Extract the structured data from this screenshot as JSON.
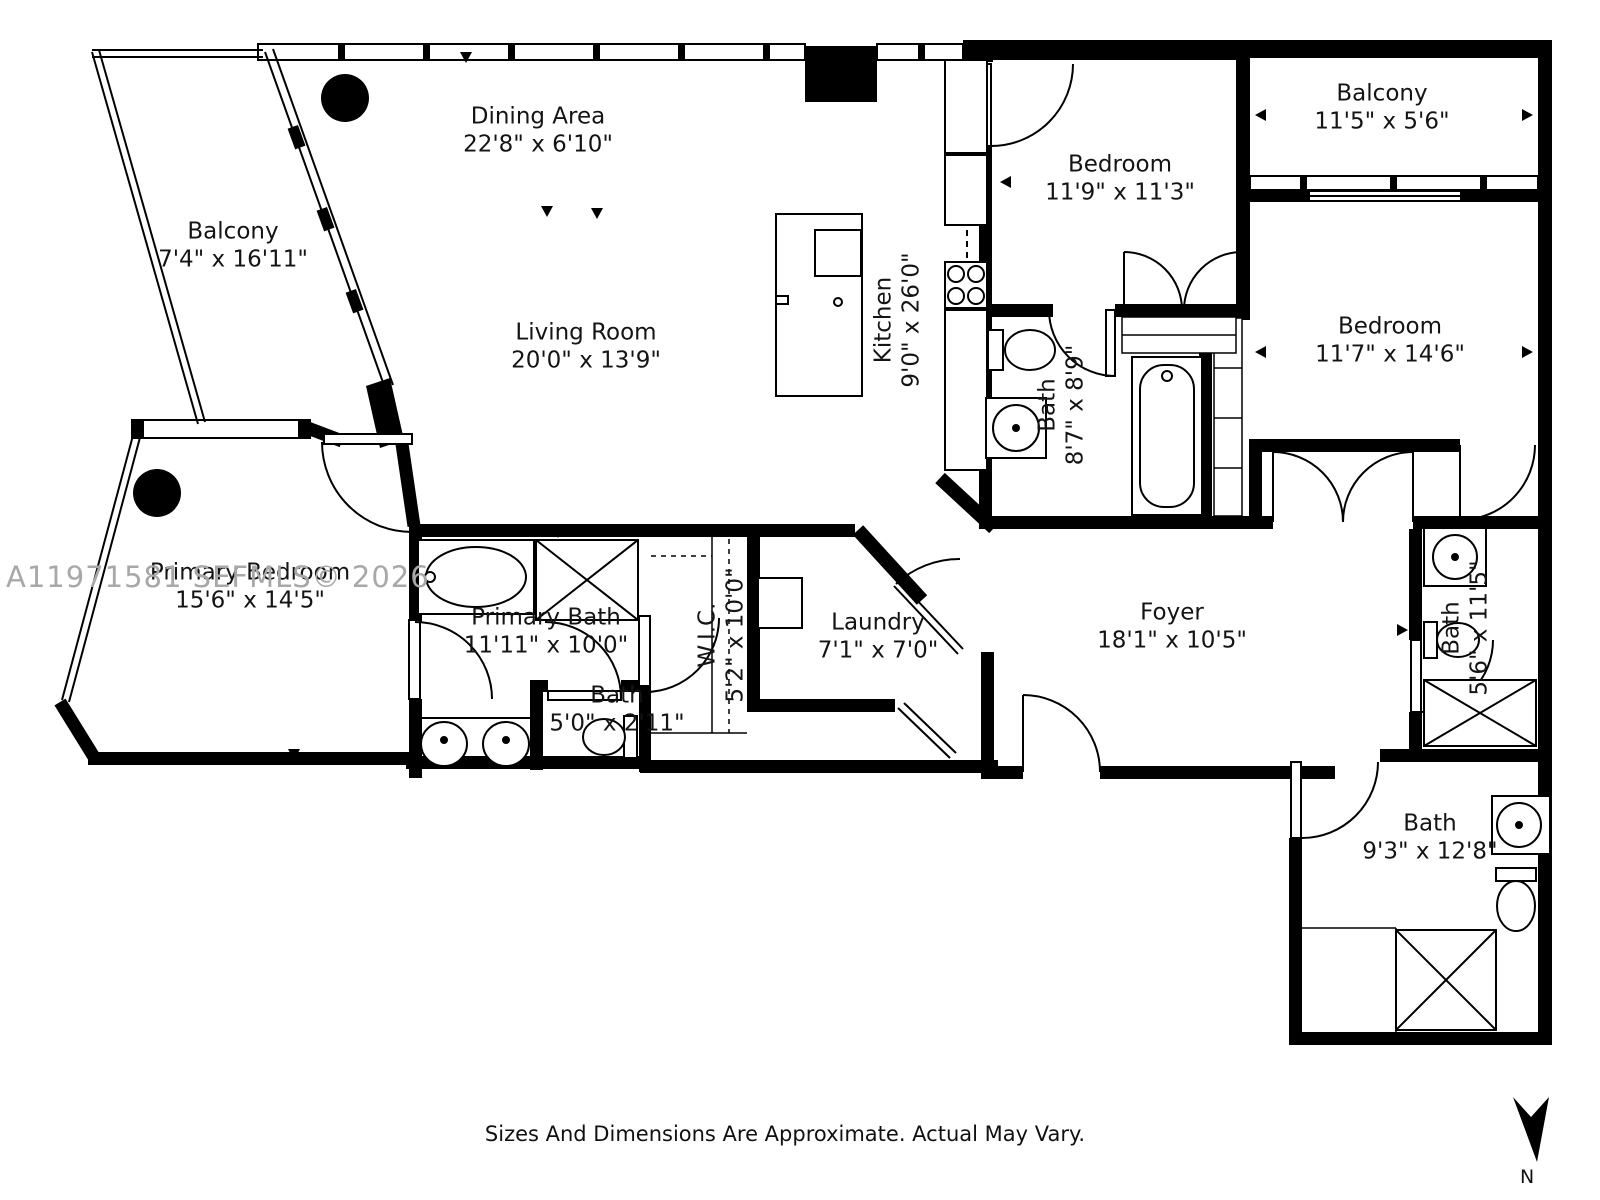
{
  "watermark": "A11971581 SEFMLS© 2026",
  "footer": {
    "disclaimer": "Sizes And Dimensions Are Approximate. Actual May Vary.",
    "north_label": "N"
  },
  "rooms": {
    "dining": {
      "name": "Dining Area",
      "dims": "22'8\" x 6'10\""
    },
    "balcony_top": {
      "name": "Balcony",
      "dims": "11'5\" x 5'6\""
    },
    "bedroom_top": {
      "name": "Bedroom",
      "dims": "11'9\" x 11'3\""
    },
    "balcony_left": {
      "name": "Balcony",
      "dims": "7'4\" x 16'11\""
    },
    "living": {
      "name": "Living Room",
      "dims": "20'0\" x 13'9\""
    },
    "kitchen": {
      "name": "Kitchen",
      "dims": "9'0\" x 26'0\""
    },
    "bath_ensuite": {
      "name": "Bath",
      "dims": "8'7\" x 8'9\""
    },
    "bedroom_right": {
      "name": "Bedroom",
      "dims": "11'7\" x 14'6\""
    },
    "primary_bedroom": {
      "name": "Primary Bedroom",
      "dims": "15'6\" x 14'5\""
    },
    "primary_bath": {
      "name": "Primary Bath",
      "dims": "11'11\" x 10'0\""
    },
    "bath_small": {
      "name": "Bath",
      "dims": "5'0\" x 2'11\""
    },
    "wic": {
      "name": "W.I.C.",
      "dims": "5'2\" x 10'0\""
    },
    "laundry": {
      "name": "Laundry",
      "dims": "7'1\" x 7'0\""
    },
    "foyer": {
      "name": "Foyer",
      "dims": "18'1\" x 10'5\""
    },
    "bath_right": {
      "name": "Bath",
      "dims": "5'6\" x 11'5\""
    },
    "bath_bottom": {
      "name": "Bath",
      "dims": "9'3\" x 12'8\""
    }
  }
}
